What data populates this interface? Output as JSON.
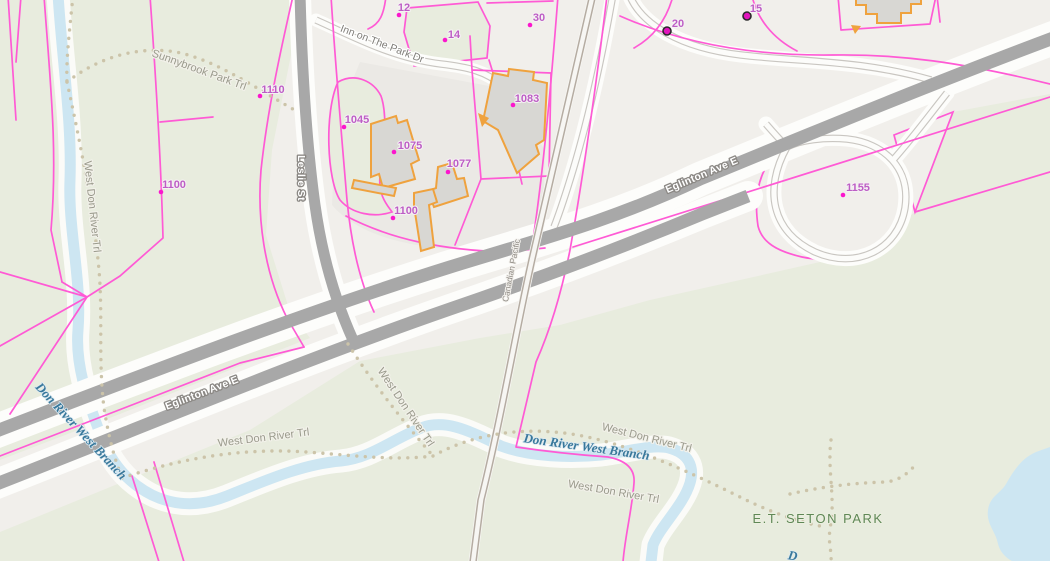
{
  "streets": {
    "eglinton": "Eglinton Ave E",
    "leslie": "Leslie St",
    "inn_on_the_park": "Inn on The Park Dr",
    "railway": "Canadian Pacific"
  },
  "water": {
    "river": "Don River West Branch",
    "river_partial": "D"
  },
  "park": {
    "et_seton": "E.T. SETON PARK"
  },
  "trails": {
    "sunnybrook": "Sunnybrook Park Trl",
    "west_don": "West Don River Trl"
  },
  "addresses": [
    {
      "label": "1110",
      "marker": "dot"
    },
    {
      "label": "1100",
      "marker": "dot"
    },
    {
      "label": "1045",
      "marker": "dot"
    },
    {
      "label": "1075",
      "marker": "dot"
    },
    {
      "label": "1077",
      "marker": "dot"
    },
    {
      "label": "1083",
      "marker": "dot"
    },
    {
      "label": "1100",
      "marker": "dot"
    },
    {
      "label": "12",
      "marker": "dot"
    },
    {
      "label": "14",
      "marker": "dot"
    },
    {
      "label": "30",
      "marker": "dot"
    },
    {
      "label": "20",
      "marker": "ringed-dot"
    },
    {
      "label": "15",
      "marker": "ringed-dot"
    },
    {
      "label": "1155",
      "marker": "dot"
    }
  ],
  "colors": {
    "parcel_line": "#ff5ad5",
    "building_outline": "#efa23e",
    "building_fill": "#d8d7d3",
    "road_fill": "#a8a8a8",
    "park_green": "#e8ecde",
    "water_blue": "#cde6f2",
    "trail_dot": "#ccc4a9",
    "address_label": "#bd5ec5",
    "address_dot": "#fb16cd",
    "park_label": "#5f8756",
    "water_label": "#38789b"
  }
}
